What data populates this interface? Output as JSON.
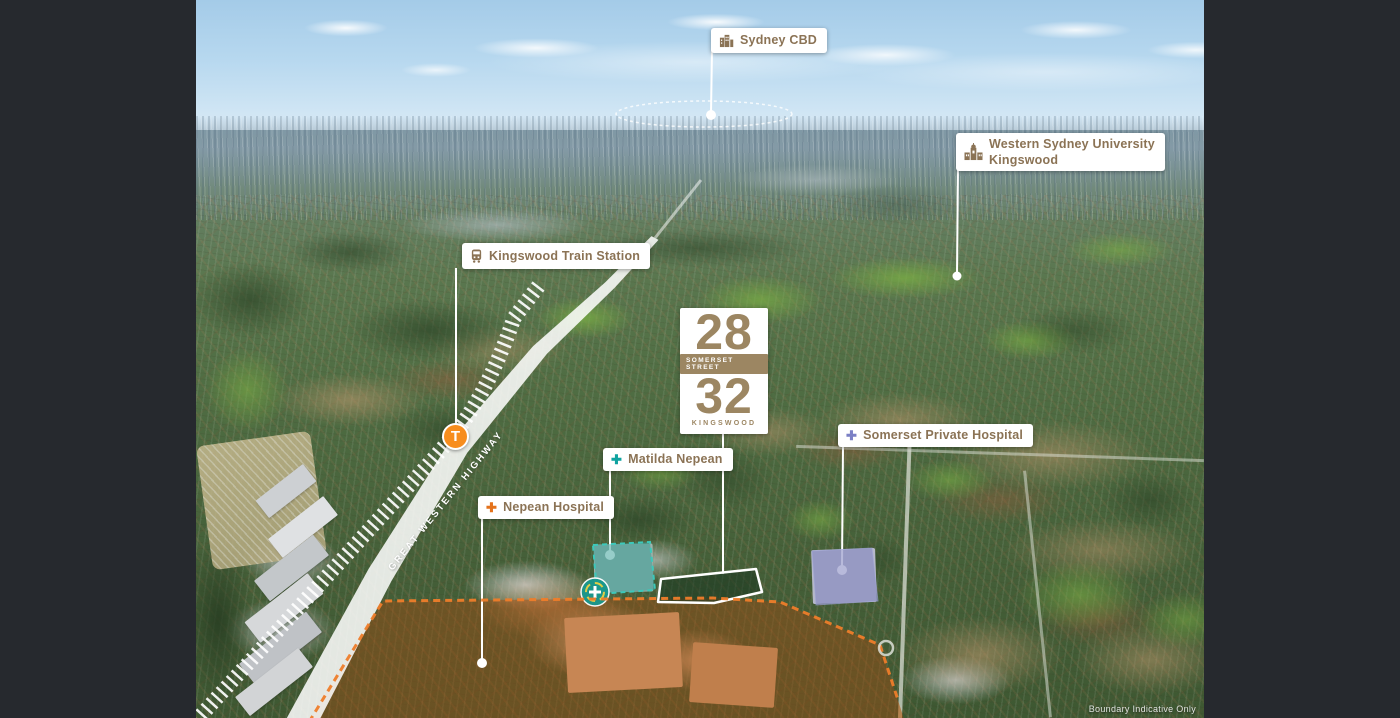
{
  "site_sign": {
    "number_top": "28",
    "street": "SOMERSET STREET",
    "number_bottom": "32",
    "suburb": "KINGSWOOD"
  },
  "callouts": {
    "sydney_cbd": {
      "label": "Sydney CBD"
    },
    "university": {
      "line1": "Western Sydney University",
      "line2": "Kingswood"
    },
    "train_station": {
      "label": "Kingswood Train Station"
    },
    "somerset_hospital": {
      "label": "Somerset Private Hospital"
    },
    "matilda_nepean": {
      "label": "Matilda Nepean"
    },
    "nepean_hospital": {
      "label": "Nepean Hospital"
    }
  },
  "highway": {
    "label": "GREAT WESTERN HIGHWAY"
  },
  "train_marker": {
    "letter": "T"
  },
  "footer": {
    "disclaimer": "Boundary Indicative Only"
  },
  "icons": {
    "hospital_cross": "✚"
  },
  "colors": {
    "frame_dark": "#26292e",
    "label_text_brown": "#8b7355",
    "sign_gold": "#9c8662",
    "train_marker_orange": "#f78d1e",
    "somerset_cross_purple": "#7b80c5",
    "matilda_cross_teal": "#0fa3a0",
    "nepean_cross_orange": "#e4721c",
    "site_boundary": "#ffffff",
    "precinct_boundary_orange": "#ee7d2a"
  }
}
